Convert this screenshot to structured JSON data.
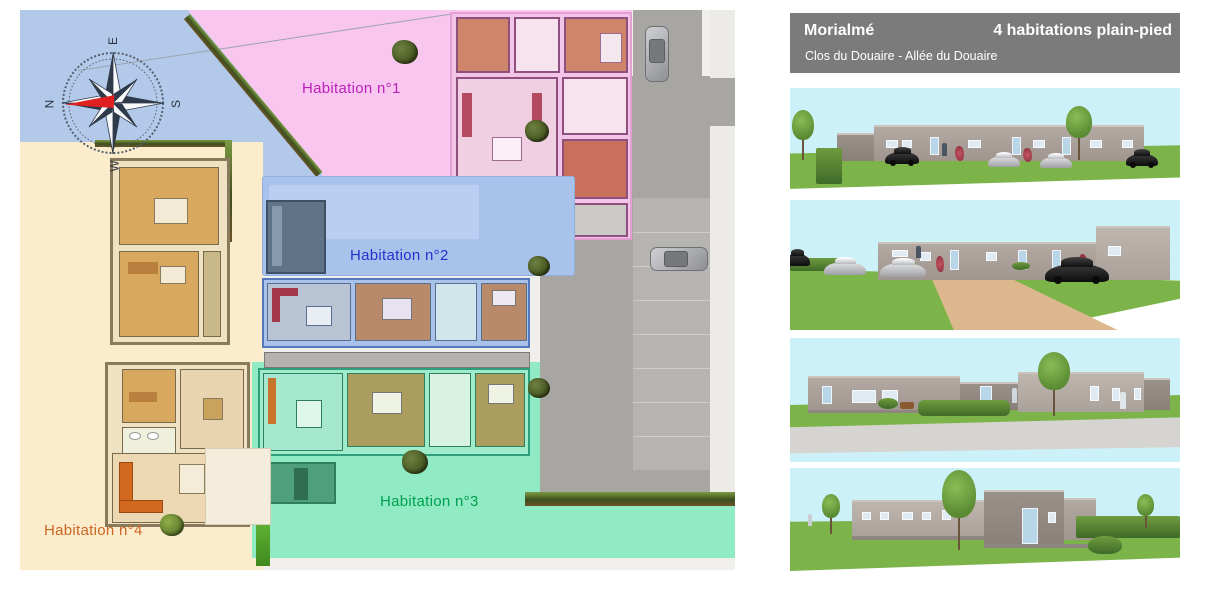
{
  "header": {
    "city": "Morialmé",
    "project": "4 habitations plain-pied",
    "address": "Clos du Douaire - Allée du Douaire"
  },
  "plan": {
    "labels": {
      "hab1": "Habitation n°1",
      "hab2": "Habitation n°2",
      "hab3": "Habitation n°3",
      "hab4": "Habitation n°4"
    },
    "compass": {
      "north": "N",
      "east": "E",
      "south": "S",
      "west": "W"
    },
    "colors": {
      "header_bg": "#7b7b7b",
      "sky_zone": "#b3c9e9",
      "hab1_zone": "#f8c6ee",
      "hab1_text": "#bb22bb",
      "hab2_zone": "#a9c2ec",
      "hab2_text": "#2233cc",
      "hab3_zone": "#90ebc4",
      "hab3_text": "#00a050",
      "hab4_zone": "#fbeccb",
      "hab4_text": "#cc6622",
      "road": "#a8a6a3",
      "sidewalk": "#edebe8",
      "hedge": "#3d4f1e",
      "render_sky": "#cdf1f9",
      "grass": "#7cb44a",
      "building": "#a79d97",
      "driveway": "#ddb88f",
      "compass_needle": "#e02020"
    }
  }
}
